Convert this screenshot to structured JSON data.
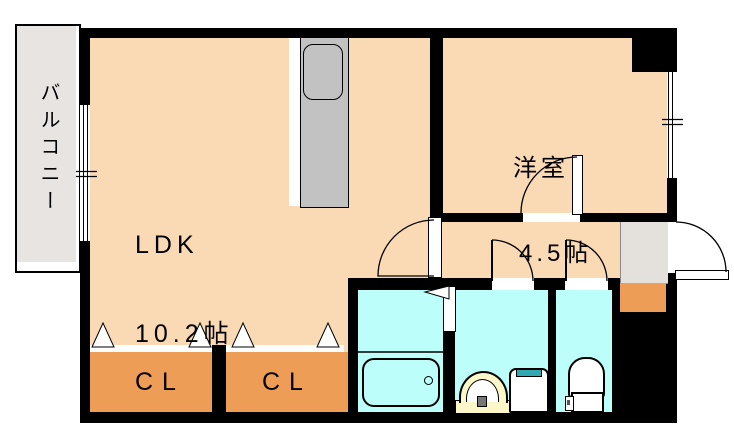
{
  "plan": {
    "title": "apartment-floorplan",
    "balcony": {
      "label": "バルコニー"
    },
    "ldk": {
      "name": "LDK",
      "size": "10.2帖"
    },
    "western_room": {
      "name": "洋室",
      "size": "4.5帖"
    },
    "closet_left": {
      "label": "CL"
    },
    "closet_right": {
      "label": "CL"
    },
    "fixtures": {
      "kitchen_counter": "kitchen-counter-with-sink",
      "bathtub": "bathtub",
      "washbasin": "washbasin",
      "washing_machine": "washing-machine-pan",
      "toilet": "toilet",
      "entrance": "entrance-door"
    },
    "colors": {
      "room_floor": "#FADAB5",
      "wet_area_floor": "#BCFEFA",
      "closet": "#EE9D56",
      "counter_gray": "#C2C2C2",
      "balcony_gray": "#E8E4E2",
      "genkan_gray": "#E4E0DC",
      "washer_accent": "#2FA8B2",
      "basin_yellow": "#FBF7C8",
      "wall": "#000000"
    }
  }
}
